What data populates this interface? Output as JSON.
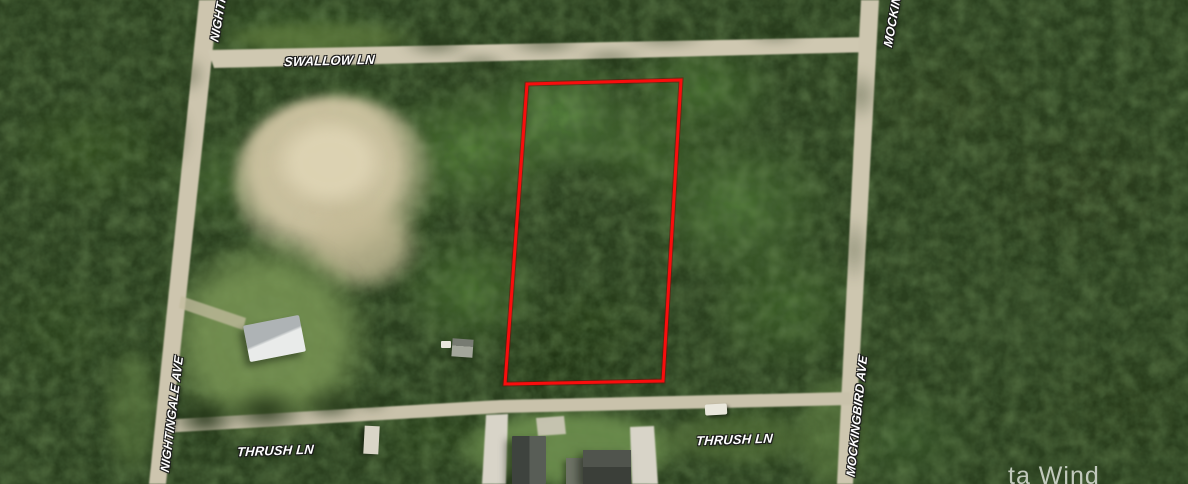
{
  "map": {
    "type": "aerial-satellite-parcel-map",
    "streets": [
      {
        "id": "swallow-ln",
        "label": "SWALLOW LN",
        "orientation": "horizontal"
      },
      {
        "id": "nightingale-ave",
        "label": "NIGHTINGALE AVE",
        "orientation": "vertical"
      },
      {
        "id": "nightingale-ave-top",
        "label": "NIGHTINGALE AVE",
        "orientation": "vertical",
        "clipped": true
      },
      {
        "id": "mockingbird-ave",
        "label": "MOCKINGBIRD AVE",
        "orientation": "vertical"
      },
      {
        "id": "mockingbird-ave-top",
        "label": "MOCKINGBIRD AVE",
        "orientation": "vertical",
        "clipped": true
      },
      {
        "id": "thrush-ln-west",
        "label": "THRUSH LN",
        "orientation": "horizontal"
      },
      {
        "id": "thrush-ln-east",
        "label": "THRUSH LN",
        "orientation": "horizontal"
      }
    ],
    "parcel": {
      "outline_color": "#f90d0d",
      "points": "527,84 681,80 663,381 505,384"
    },
    "watermark": {
      "text": "ta Wind"
    },
    "map_features": {
      "parcel_highlighted": true,
      "structures_visible": 5,
      "vehicles_visible": 3
    },
    "colors": {
      "forest": "#2a3f1e",
      "dirt_road": "#cfc8b1",
      "clearing": "#d0c5a3",
      "parcel_outline": "#f90d0d"
    }
  }
}
